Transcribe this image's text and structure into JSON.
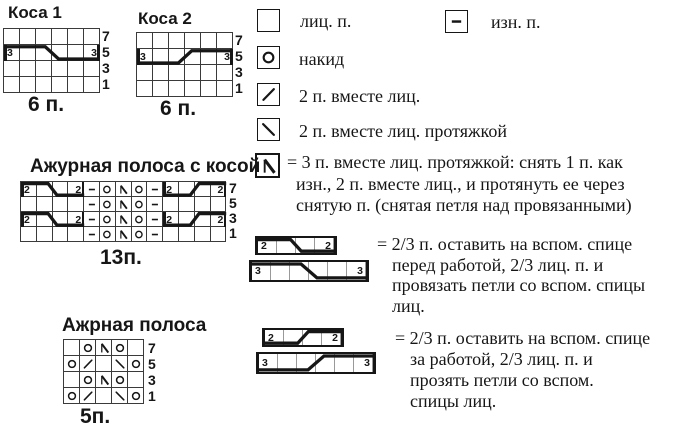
{
  "page": {
    "bg": "#ffffff",
    "ink": "#161616",
    "grid_line": "#3a3a3a"
  },
  "charts": {
    "kosa1": {
      "title": "Коса 1",
      "stitches_label": "6 п.",
      "row_numbers": [
        "7",
        "5",
        "3",
        "1"
      ],
      "cols": 6,
      "rows": [
        [
          "k",
          "k",
          "k",
          "k",
          "k",
          "k"
        ],
        [
          "k",
          "k",
          "k",
          "k",
          "k",
          "k"
        ],
        [
          "k",
          "k",
          "k",
          "k",
          "k",
          "k"
        ],
        [
          "k",
          "k",
          "k",
          "k",
          "k",
          "k"
        ]
      ],
      "cables": [
        {
          "row": 1,
          "col": 0,
          "span": 6,
          "dir": "front",
          "digit": "3"
        }
      ]
    },
    "kosa2": {
      "title": "Коса 2",
      "stitches_label": "6 п.",
      "row_numbers": [
        "7",
        "5",
        "3",
        "1"
      ],
      "cols": 6,
      "rows": [
        [
          "k",
          "k",
          "k",
          "k",
          "k",
          "k"
        ],
        [
          "k",
          "k",
          "k",
          "k",
          "k",
          "k"
        ],
        [
          "k",
          "k",
          "k",
          "k",
          "k",
          "k"
        ],
        [
          "k",
          "k",
          "k",
          "k",
          "k",
          "k"
        ]
      ],
      "cables": [
        {
          "row": 1,
          "col": 0,
          "span": 6,
          "dir": "back",
          "digit": "3"
        }
      ]
    },
    "azhur_kosa": {
      "title": "Ажурная полоса с косой",
      "stitches_label": "13п.",
      "row_numbers": [
        "7",
        "5",
        "3",
        "1"
      ],
      "cols": 13,
      "rows": [
        [
          "k",
          "k",
          "k",
          "k",
          "p",
          "yo",
          "sk2p",
          "yo",
          "p",
          "k",
          "k",
          "k",
          "k"
        ],
        [
          "k",
          "k",
          "k",
          "k",
          "p",
          "yo",
          "sk2p",
          "yo",
          "p",
          "k",
          "k",
          "k",
          "k"
        ],
        [
          "k",
          "k",
          "k",
          "k",
          "p",
          "yo",
          "sk2p",
          "yo",
          "p",
          "k",
          "k",
          "k",
          "k"
        ],
        [
          "k",
          "k",
          "k",
          "k",
          "p",
          "yo",
          "sk2p",
          "yo",
          "p",
          "k",
          "k",
          "k",
          "k"
        ]
      ],
      "cables": [
        {
          "row": 0,
          "col": 0,
          "span": 4,
          "dir": "front",
          "digit": "2"
        },
        {
          "row": 0,
          "col": 9,
          "span": 4,
          "dir": "back",
          "digit": "2"
        },
        {
          "row": 2,
          "col": 0,
          "span": 4,
          "dir": "front",
          "digit": "2"
        },
        {
          "row": 2,
          "col": 9,
          "span": 4,
          "dir": "back",
          "digit": "2"
        }
      ]
    },
    "azhur": {
      "title": "Ажрная полоса",
      "stitches_label": "5п.",
      "row_numbers": [
        "7",
        "5",
        "3",
        "1"
      ],
      "cols": 5,
      "rows": [
        [
          "k",
          "yo",
          "sk2p",
          "yo",
          "k"
        ],
        [
          "yo",
          "dec_r",
          "k",
          "dec_l",
          "yo"
        ],
        [
          "k",
          "yo",
          "sk2p",
          "yo",
          "k"
        ],
        [
          "yo",
          "dec_r",
          "k",
          "dec_l",
          "yo"
        ]
      ],
      "cables": []
    }
  },
  "legend": {
    "knit": {
      "symbol": "k",
      "label": "лиц. п."
    },
    "purl": {
      "symbol": "p",
      "label": "изн. п."
    },
    "yo": {
      "symbol": "yo",
      "label": "накид"
    },
    "k2tog": {
      "symbol": "dec_r",
      "label": "2 п. вместе лиц."
    },
    "ssk": {
      "symbol": "dec_l",
      "label": "2 п. вместе лиц. протяжкой"
    },
    "sk2p": {
      "symbol": "sk2p",
      "lines": [
        "= 3 п. вместе лиц. протяжкой: снять 1 п. как",
        "изн., 2 п. вместе лиц., и протянуть ее через",
        "снятую п. (снятая петля над провязанными)"
      ]
    },
    "cable_front": {
      "bars": [
        {
          "span": 4,
          "digit": "2",
          "dir": "front"
        },
        {
          "span": 6,
          "digit": "3",
          "dir": "front"
        }
      ],
      "lines": [
        "= 2/3 п. оставить на вспом. спице",
        "перед работой, 2/3 лиц. п. и",
        "провязать петли со вспом. спицы",
        "лиц."
      ]
    },
    "cable_back": {
      "bars": [
        {
          "span": 4,
          "digit": "2",
          "dir": "back"
        },
        {
          "span": 6,
          "digit": "3",
          "dir": "back"
        }
      ],
      "lines": [
        "= 2/3 п. оставить на вспом. спице",
        "за работой, 2/3 лиц. п. и",
        "прозять петли со вспом.",
        "спицы лиц."
      ]
    }
  }
}
